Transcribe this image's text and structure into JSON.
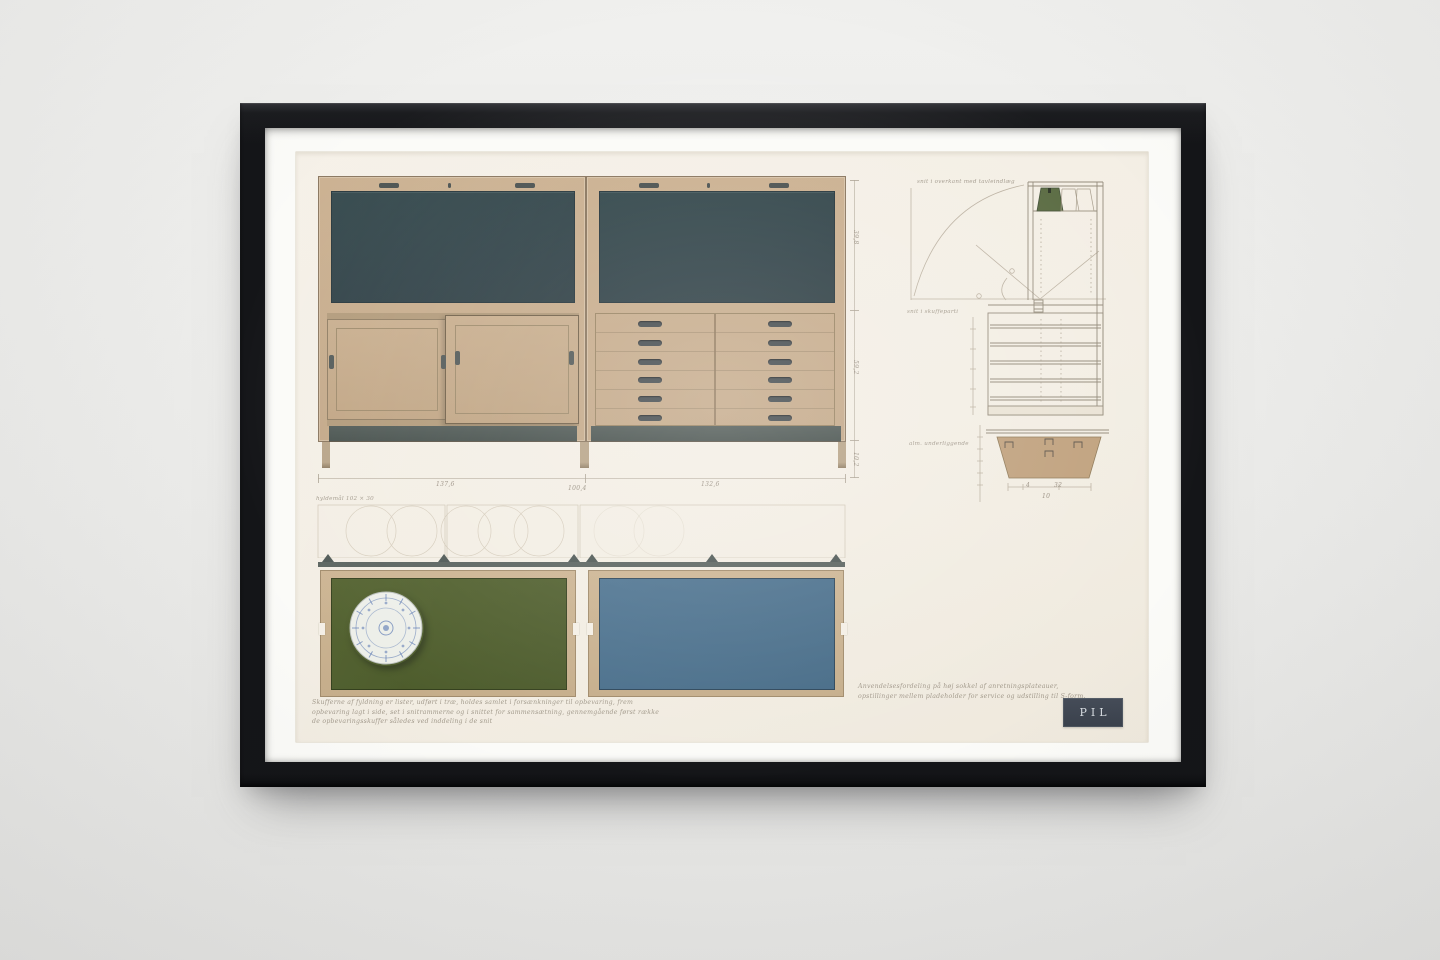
{
  "artwork": {
    "plate_label": "PIL",
    "caption_lines": [
      "Skufferne af fyldning er lister, udført i træ, holdes samlet i forsænkninger til opbevaring, frem",
      "opbevaring lagt i side, set i snitrammerne og i snittet for sammensætning, gennemgående først række",
      "de opbevaringsskuffer således ved inddeling i de snit"
    ],
    "note_lines": [
      "Anvendelsesfordeling på høj sokkel af anretningsplateauer,",
      "opstillinger mellem pladeholder for service og udstilling til S-form."
    ],
    "plan_label": "hyldemål 102 × 30",
    "section_labels": {
      "top": "snit i overkant med tavleindlæg",
      "mid": "snit i skuffeparti",
      "bottom": "alm. underliggende"
    },
    "dims": {
      "bottom": [
        "137,6",
        "100,4",
        "132,6"
      ],
      "right": [
        "39,8",
        "59,2",
        "10,2"
      ],
      "detail": [
        "4",
        "32",
        "10"
      ]
    },
    "colors": {
      "wall": "#ebebe9",
      "frame": "#17181a",
      "mat": "#fbfbf8",
      "paper": "#f4efe6",
      "wood": "#c5ab8b",
      "panel_teal": "#2c4045",
      "plinth": "#49534f",
      "plan_green": "#4f5e2d",
      "plan_blue": "#4a6f8b",
      "plate_blue": "#4466aa",
      "vase_green": "#5a6b42",
      "label_bg": "#3e4550",
      "ink": "#a79d8f"
    }
  }
}
